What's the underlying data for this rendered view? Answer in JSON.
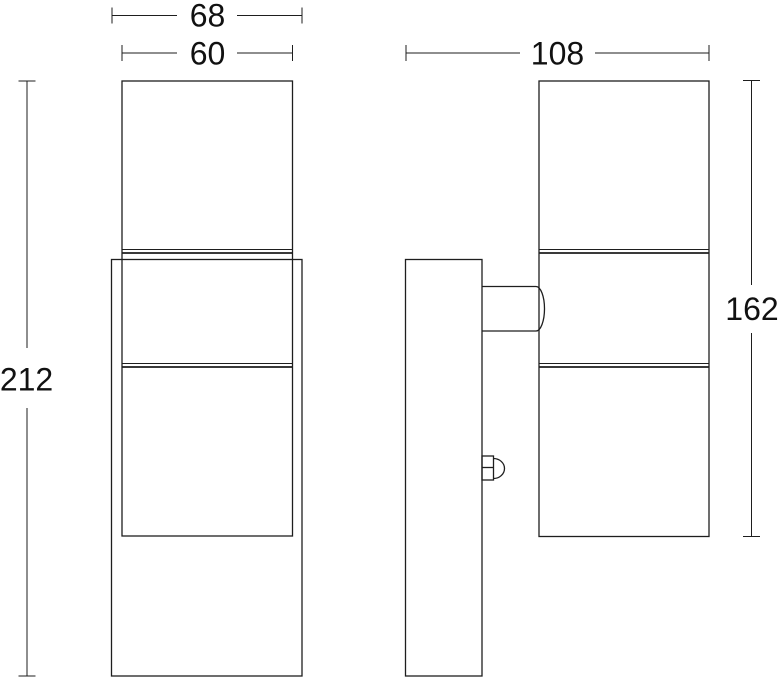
{
  "drawing": {
    "front_view": {
      "outer_width_mm": "68",
      "body_width_mm": "60",
      "total_height_mm": "212"
    },
    "side_view": {
      "total_depth_mm": "108",
      "body_height_mm": "162"
    },
    "colors": {
      "line": "#1e1e1e",
      "text": "#111111",
      "background": "#ffffff"
    }
  }
}
